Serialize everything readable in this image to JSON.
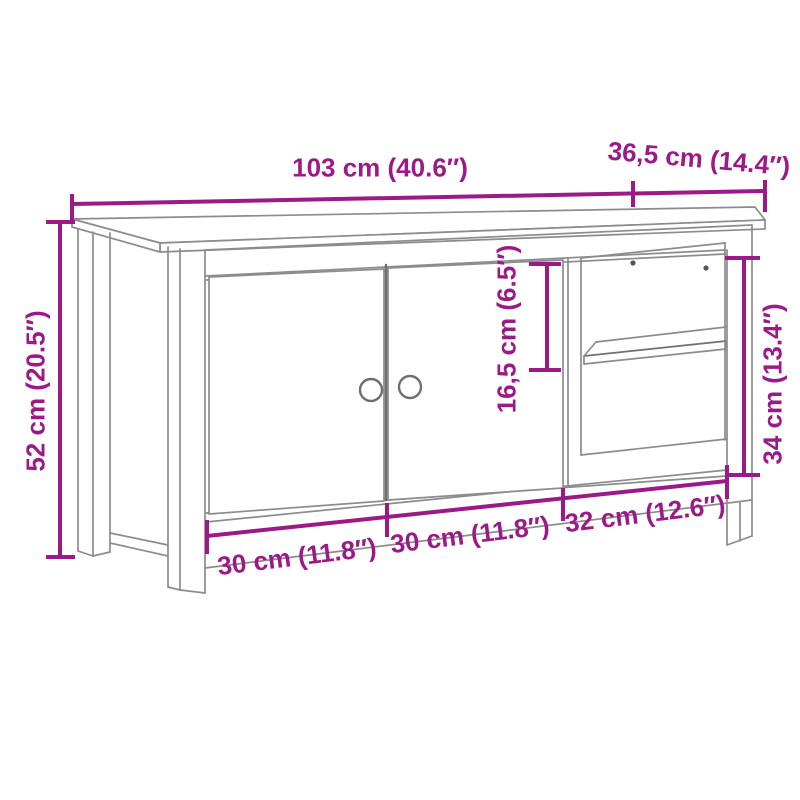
{
  "colors": {
    "dimension_annotation": "#9B1A87",
    "drawing_lines": "#8C8C8C",
    "background": "#FFFFFF"
  },
  "diagram": {
    "kind": "furniture-dimension-diagram",
    "subject": "tv-cabinet-two-doors-open-shelf"
  },
  "dimensions": {
    "overall_width": "103 cm (40.6″)",
    "overall_depth": "36,5 cm (14.4″)",
    "overall_height": "52 cm (20.5″)",
    "compartment_top_height": "16,5 cm (6.5″)",
    "open_section_height": "34 cm (13.4″)",
    "left_door_width": "30 cm (11.8″)",
    "right_door_width": "30 cm (11.8″)",
    "open_section_width": "32 cm (12.6″)"
  }
}
